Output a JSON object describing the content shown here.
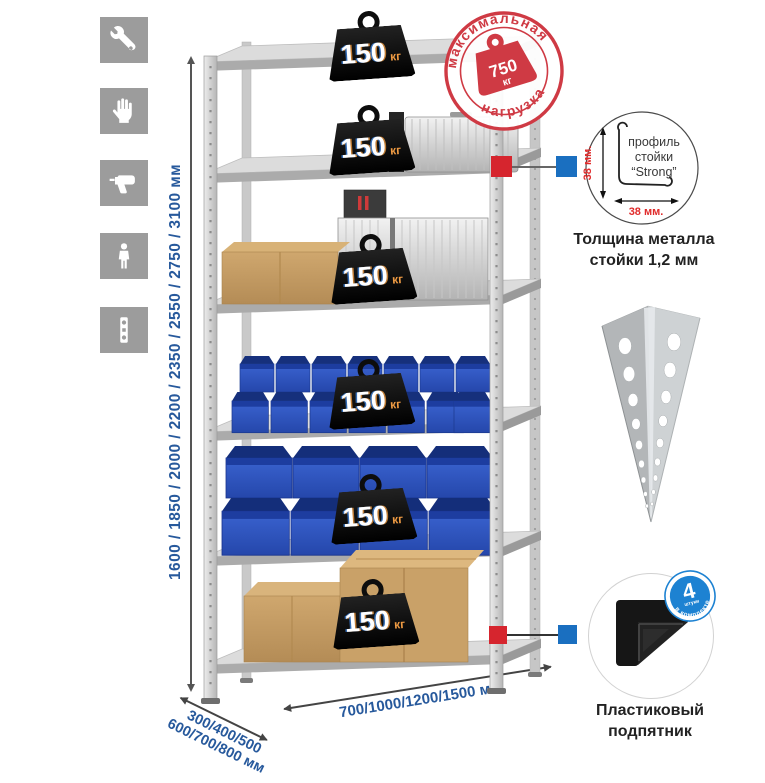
{
  "sidebar": {
    "icons": [
      {
        "name": "wrench"
      },
      {
        "name": "gloves"
      },
      {
        "name": "drill"
      },
      {
        "name": "person"
      },
      {
        "name": "spirit-level"
      }
    ]
  },
  "height_dimension": {
    "label": "1600 / 1850 / 2000 / 2200 / 2350 / 2550 / 2750 / 3100 мм"
  },
  "rack": {
    "shelf_count": 6,
    "shelf_load": {
      "value": "150",
      "unit": "кг"
    }
  },
  "max_load_stamp": {
    "arc_top": "максимальная",
    "arc_bottom": "нагрузка",
    "value": "750",
    "unit": "кг"
  },
  "profile_detail": {
    "label_line1": "профиль",
    "label_line2": "стойки",
    "label_line3": "“Strong”",
    "dim_vertical": "38 мм.",
    "dim_horizontal": "38 мм.",
    "caption_line1": "Толщина металла",
    "caption_line2": "стойки 1,2 мм"
  },
  "foot_detail": {
    "badge_value": "4",
    "badge_sub": "штуки",
    "badge_arc": "в комплекте",
    "caption_line1": "Пластиковый",
    "caption_line2": "подпятник"
  },
  "depth_dimension": {
    "line1": "300/400/500",
    "line2": "600/700/800 мм"
  },
  "width_dimension": {
    "label": "700/1000/1200/1500 мм"
  },
  "colors": {
    "accent_blue": "#27599c",
    "stamp_red": "#cf3a44",
    "badge_blue": "#1d82d2",
    "marker_red": "#d6252e",
    "marker_blue": "#1a6fc0",
    "weight_black": "#101010",
    "weight_unit_orange": "#ef9b43",
    "icon_gray": "#9c9c9c"
  }
}
